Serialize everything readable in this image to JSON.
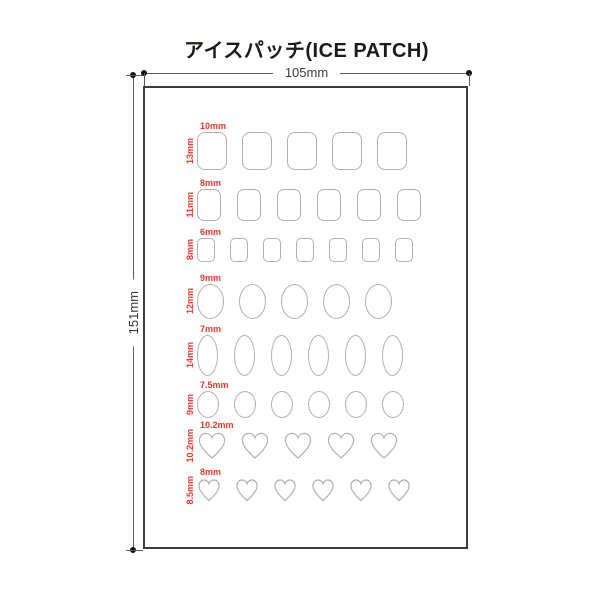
{
  "title": "アイスパッチ(ICE PATCH)",
  "dimensions": {
    "width_label": "105mm",
    "height_label": "151mm"
  },
  "colors": {
    "accent_red": "#e8392d",
    "shape_outline": "#b3b0b0",
    "sheet_border": "#403a37",
    "dimension_line": "#5a5a5a"
  },
  "rows": [
    {
      "shape": "rounded-rect",
      "count": 5,
      "width_mm": 10,
      "height_mm": 13,
      "width_label": "10mm",
      "height_label": "13mm"
    },
    {
      "shape": "rounded-rect",
      "count": 6,
      "width_mm": 8,
      "height_mm": 11,
      "width_label": "8mm",
      "height_label": "11mm"
    },
    {
      "shape": "rounded-rect",
      "count": 7,
      "width_mm": 6,
      "height_mm": 8,
      "width_label": "6mm",
      "height_label": "8mm"
    },
    {
      "shape": "oval",
      "count": 5,
      "width_mm": 9,
      "height_mm": 12,
      "width_label": "9mm",
      "height_label": "12mm"
    },
    {
      "shape": "oval",
      "count": 6,
      "width_mm": 7,
      "height_mm": 14,
      "width_label": "7mm",
      "height_label": "14mm"
    },
    {
      "shape": "oval",
      "count": 6,
      "width_mm": 7.5,
      "height_mm": 9,
      "width_label": "7.5mm",
      "height_label": "9mm"
    },
    {
      "shape": "heart",
      "count": 5,
      "width_mm": 10.2,
      "height_mm": 10.2,
      "width_label": "10.2mm",
      "height_label": "10.2mm"
    },
    {
      "shape": "heart",
      "count": 6,
      "width_mm": 8,
      "height_mm": 8.5,
      "width_label": "8mm",
      "height_label": "8.5mm"
    }
  ]
}
